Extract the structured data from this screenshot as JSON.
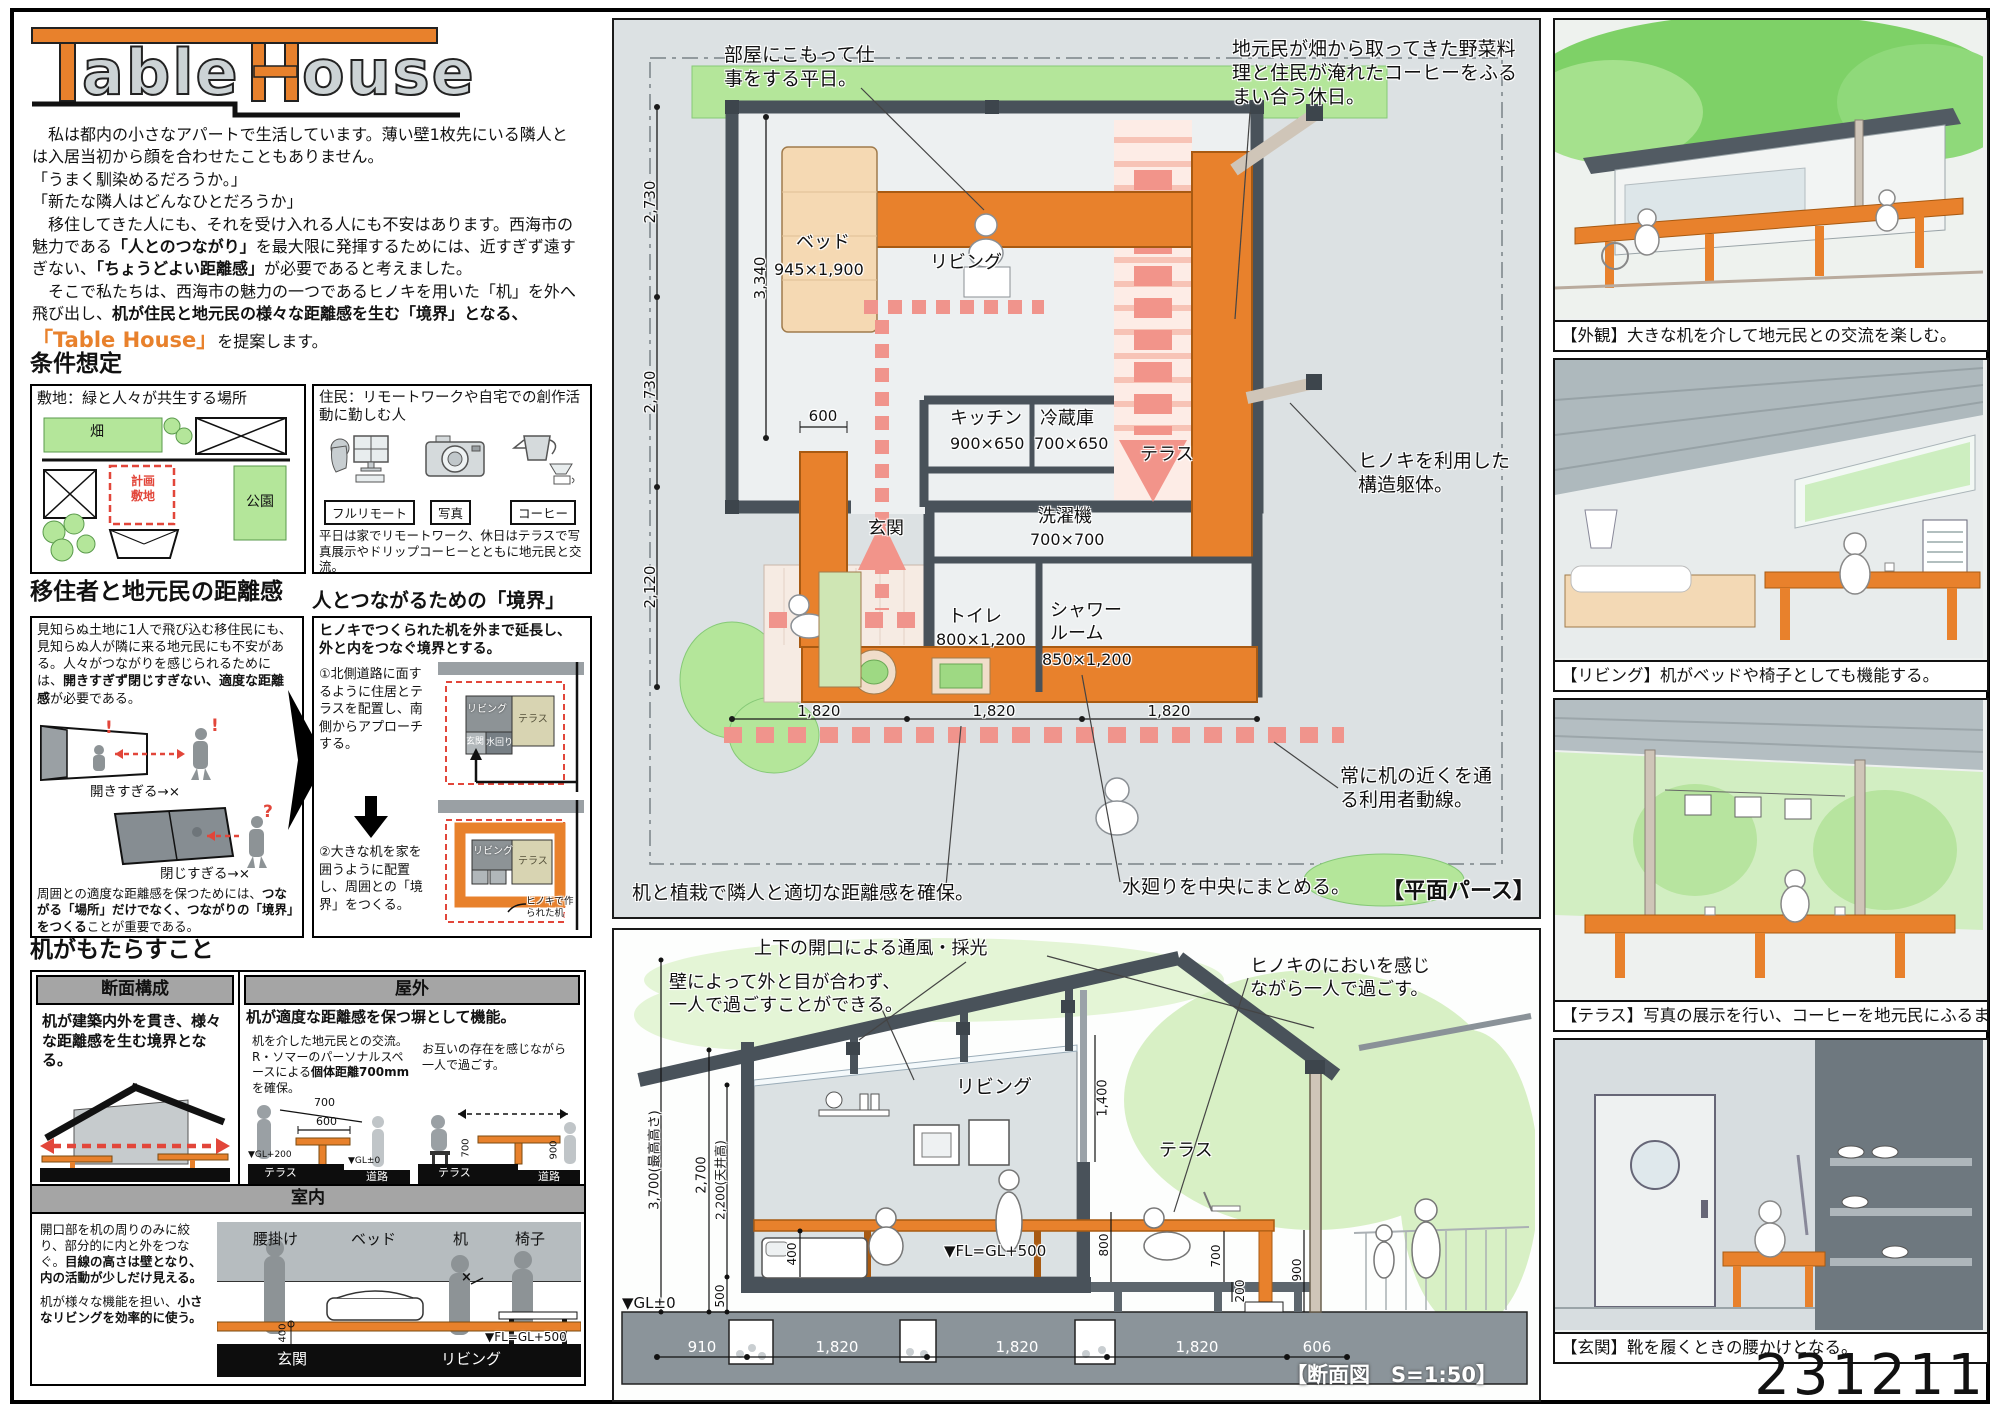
{
  "colors": {
    "accent": "#e8812c",
    "red": "#e2463a",
    "pink": "#f0948c",
    "green": "#b4e69a",
    "wall": "#49525a"
  },
  "logo": {
    "t": "T",
    "able": "able",
    "h": "H",
    "ouse": "ouse"
  },
  "intro": {
    "p1": "　私は都内の小さなアパートで生活しています。薄い壁1枚先にいる隣人とは入居当初から顔を合わせたこともありません。",
    "p2": "「うまく馴染めるだろうか。」",
    "p3": "「新たな隣人はどんなひとだろうか」",
    "p4a": "　移住してきた人にも、それを受け入れる人にも不安はあります。西海市の魅力である",
    "p4b": "「人とのつながり」",
    "p4c": "を最大限に発揮するためには、近すぎず遠すぎない、",
    "p4d": "「ちょうどよい距離感」",
    "p4e": "が必要であると考えました。",
    "p5a": "　そこで私たちは、西海市の魅力の一つであるヒノキを用いた「机」を外へ飛び出し、",
    "p5b": "机が住民と地元民の様々な距離感を生む「境界」となる、",
    "p6a": "「Table House」",
    "p6b": "を提案します。"
  },
  "joken": {
    "heading": "条件想定",
    "site_title": "敷地：緑と人々が共生する場所",
    "hatake": "畑",
    "keikaku": "計画\n敷地",
    "kouen": "公園",
    "resident_title": "住民：リモートワークや自宅での創作活動に勤しむ人",
    "tags": [
      "フルリモート",
      "写真",
      "コーヒー"
    ],
    "resident_caption": "平日は家でリモートワーク、休日はテラスで写真展示やドリップコーヒーとともに地元民と交流。"
  },
  "distance": {
    "heading": "移住者と地元民の距離感",
    "p1a": "見知らぬ土地に1人で飛び込む移住民にも、見知らぬ人が隣に来る地元民にも不安がある。人々がつながりを感じられるためには、",
    "p1b": "開きすぎず閉じすぎない、適度な距離感",
    "p1c": "が必要である。",
    "excl": "!",
    "quest": "?",
    "cap_open": "開きすぎる→×",
    "cap_close": "閉じすぎる→×",
    "p2a": "周囲との適度な距離感を保つためには、",
    "p2b": "つながる「場所」だけでなく、つながりの「境界」をつくる",
    "p2c": "ことが重要である。"
  },
  "boundary": {
    "heading": "人とつながるための「境界」",
    "lead": "ヒノキでつくられた机を外まで延長し、外と内をつなぐ境界とする。",
    "step1": "①北側道路に面するように住居とテラスを配置し、南側からアプローチする。",
    "step2": "②大きな机を家を囲うように配置し、周囲との「境界」をつくる。",
    "living": "リビング",
    "terrace": "テラス",
    "genkan": "玄関",
    "mizumawari": "水回り",
    "desk_note": "ヒノキで作\nられた机"
  },
  "desk": {
    "heading": "机がもたらすこと",
    "h_danmen": "断面構成",
    "h_okugai": "屋外",
    "h_shitsunai": "室内",
    "danmen_text": "机が建築内外を貫き、様々な距離感を生む境界となる。",
    "okugai_lead": "机が適度な距離感を保つ塀として機能。",
    "ol_a": "机を介した地元民との交流。R・ソマーのパーソナルスペースによる",
    "ol_b": "個体距離700mm",
    "ol_c": "を確保。",
    "d700": "700",
    "d600": "600",
    "gl200": "▼GL+200",
    "gl0": "▼GL±0",
    "terrace": "テラス",
    "road": "道路",
    "or_text": "お互いの存在を感じながら一人で過ごす。",
    "d700v": "700",
    "d900": "900",
    "s1a": "開口部を机の周りのみに絞り、部分的に内と外をつなぐ。",
    "s1b": "目線の高さは壁となり、内の活動が少しだけ見える。",
    "s2a": "机が様々な機能を担い、",
    "s2b": "小さなリビングを効率的に使う。",
    "in_labels": [
      "腰掛け",
      "ベッド",
      "机",
      "椅子"
    ],
    "x_mark": "×",
    "d400": "400",
    "fl": "▼FL=GL+500",
    "bottom_genkan": "玄関",
    "bottom_living": "リビング"
  },
  "plan": {
    "work_note": "部屋にこもって仕\n事をする平日。",
    "holiday_note": "地元民が畑から取ってきた野菜料\n理と住民が淹れたコーヒーをふる\nまい合う休日。",
    "hinoki_note": "ヒノキを利用した\n構造躯体。",
    "flow_note": "常に机の近くを通\nる利用者動線。",
    "mizu_note": "水廻りを中央にまとめる。",
    "plant_note": "机と植栽で隣人と適切な距離感を確保。",
    "bed": "ベッド",
    "bed_size": "945×1,900",
    "living": "リビング",
    "kitchen": "キッチン",
    "kitchen_size": "900×650",
    "fridge": "冷蔵庫",
    "fridge_size": "700×650",
    "terrace": "テラス",
    "genkan": "玄関",
    "washer": "洗濯機",
    "washer_size": "700×700",
    "toilet": "トイレ",
    "toilet_size": "800×1,200",
    "shower": "シャワー\nルーム",
    "shower_size": "850×1,200",
    "v1": "2,730",
    "v2": "2,730",
    "v3": "2,120",
    "bed_dim": "3,340",
    "d600": "600",
    "b1": "1,820",
    "b2": "1,820",
    "b3": "1,820",
    "caption": "【平面パース】"
  },
  "sec": {
    "vent_note": "上下の開口による通風・採光",
    "wall_note": "壁によって外と目が合わず、\n一人で過ごすことができる。",
    "hinoki_note": "ヒノキのにおいを感じ\nながら一人で過ごす。",
    "living": "リビング",
    "terrace": "テラス",
    "h1": "3,700(最高高さ)",
    "h2": "2,700",
    "h3": "2,200(天井高)",
    "d500": "500",
    "d400": "400",
    "d1400": "1,400",
    "d800": "800",
    "d700": "700",
    "d200": "200",
    "d900": "900",
    "gl": "▼GL±0",
    "fl": "▼FL=GL+500",
    "b1": "910",
    "b2": "1,820",
    "b3": "1,820",
    "b4": "1,820",
    "b5": "606",
    "caption": "【断面図　S=1:50】"
  },
  "gallery": [
    {
      "caption": "【外観】大きな机を介して地元民との交流を楽しむ。"
    },
    {
      "caption": "【リビング】机がベッドや椅子としても機能する。"
    },
    {
      "caption": "【テラス】写真の展示を行い、コーヒーを地元民にふるまう。"
    },
    {
      "caption": "【玄関】靴を履くときの腰かけとなる。"
    }
  ],
  "meta": {
    "id": "231211"
  }
}
